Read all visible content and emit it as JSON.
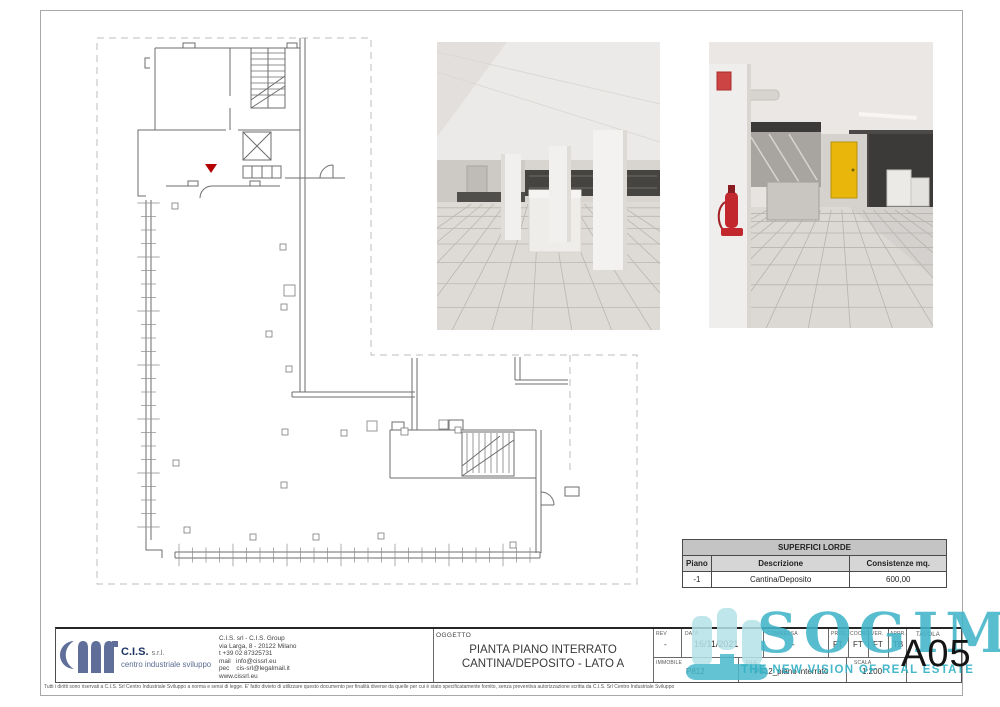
{
  "company": {
    "name": "C.I.S.",
    "suffix": "s.r.l.",
    "subtitle": "centro industriale sviluppo",
    "info": "C.I.S. srl - C.I.S. Group\nvia Larga, 8 - 20122 Milano\nt +39 02 87325731\nmail   info@cissrl.eu\npec    cis-srl@legalmail.it\nwww.cissrl.eu"
  },
  "oggetto": {
    "label": "OGGETTO",
    "line1": "PIANTA PIANO INTERRATO",
    "line2": "CANTINA/DEPOSITO - LATO A"
  },
  "meta": {
    "rev_label": "REV",
    "rev": "-",
    "data_label": "DATA",
    "data": "16/11/2021",
    "commessa_label": "COMMESSA",
    "commessa": "-",
    "prog_label": "PROG.",
    "prog": "FT",
    "coord_label": "COORD.",
    "coord": "FT",
    "ver_label": "VER.",
    "ver": "FT",
    "appr_label": "APPR.",
    "appr": "TB",
    "tavola_label": "TAVOLA",
    "tavola": "A05",
    "immobile_label": "IMMOBILE",
    "immobile": "P812",
    "file_label": "FILE",
    "file": "P812_piano interrato",
    "scala_label": "SCALA",
    "scala": "1:200"
  },
  "table": {
    "title": "SUPERFICI LORDE",
    "columns": [
      "Piano",
      "Descrizione",
      "Consistenze mq."
    ],
    "rows": [
      [
        "-1",
        "Cantina/Deposito",
        "600,00"
      ]
    ]
  },
  "watermark": {
    "wordmark": "SOGIM",
    "tagline": "THE NEW VISION OF REAL ESTATE",
    "color": "#3cb3c7"
  },
  "disclaimer": "Tutti i diritti sono riservati a C.I.S. Srl Centro Industriale Sviluppo a norma e sensi di legge. E' fatto divieto di utilizzare questo documento per finalità diverse da quelle per cui è stato specificatamente fornito, senza preventiva autorizzazione scritta da C.I.S. Srl Centro Industriale Sviluppo",
  "colors": {
    "cis_blue": "#5f6f99",
    "teal": "#3cb3c7",
    "plan_line": "#6e6e6e",
    "marker_red": "#b30000"
  }
}
